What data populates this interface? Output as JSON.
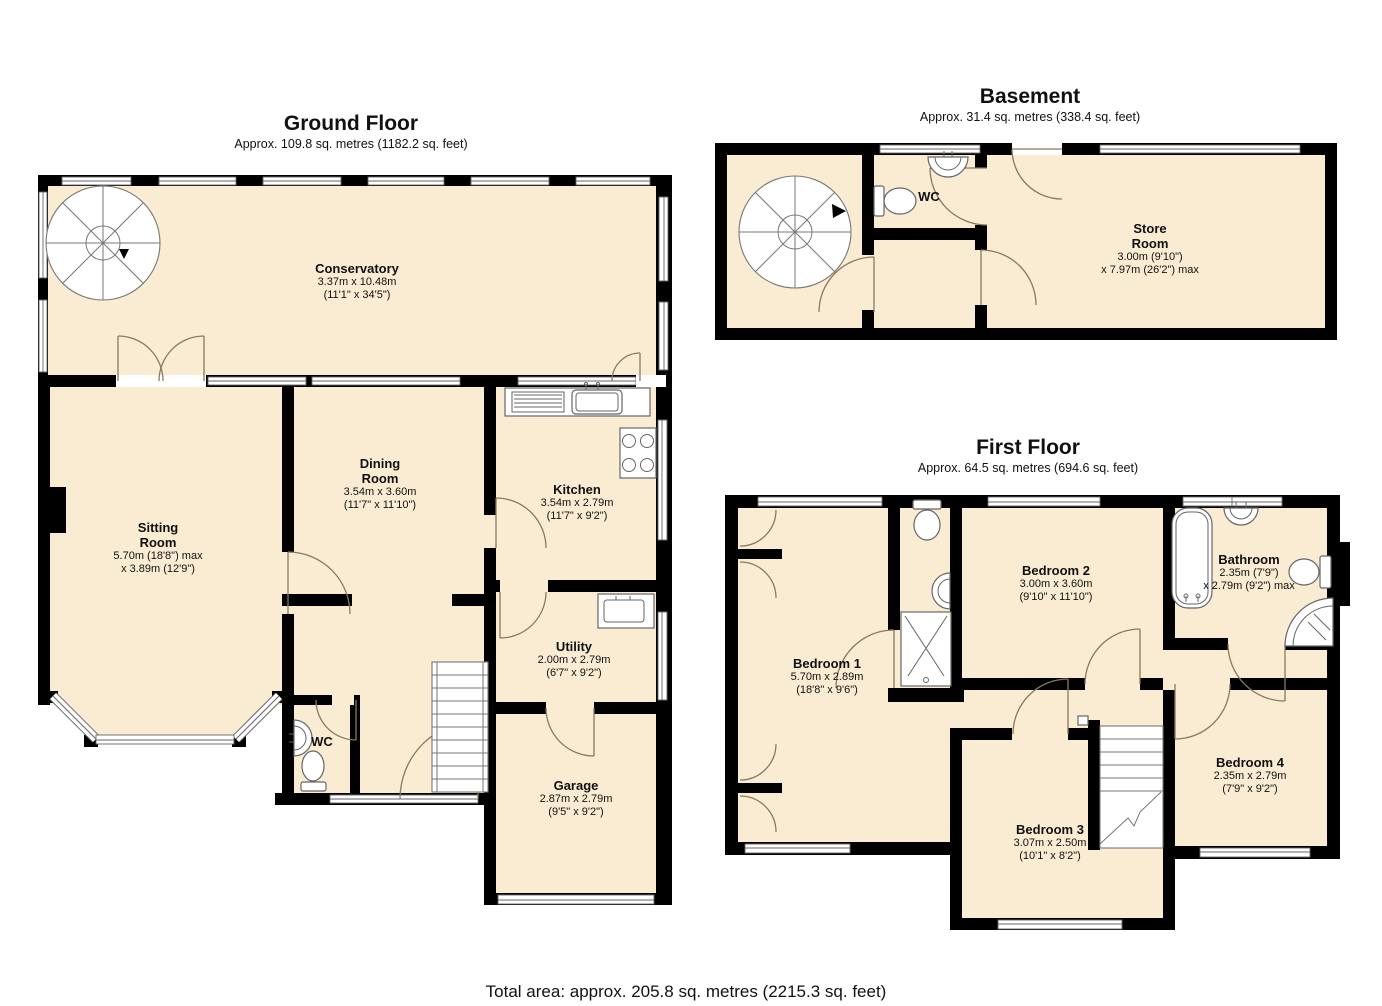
{
  "page": {
    "total_area": "Total area: approx. 205.8 sq. metres (2215.3 sq. feet)"
  },
  "colors": {
    "room_fill": "#FAECD2",
    "wall": "#000000",
    "door_arc": "#8A795D",
    "fixture_stroke": "#666666"
  },
  "fixtures": {
    "ground": [
      "spiral-staircase",
      "staircase",
      "kitchen-sink",
      "hob",
      "utility-sink",
      "wc-sink",
      "wc-toilet",
      "bay-window",
      "garage-door",
      "front-door"
    ],
    "basement": [
      "spiral-staircase",
      "wc-sink",
      "wc-toilet"
    ],
    "first": [
      "staircase",
      "ensuite-toilet",
      "ensuite-sink",
      "shower-tray",
      "bath",
      "bathroom-sink",
      "bathroom-toilet",
      "corner-shower",
      "wardrobe-doors"
    ]
  },
  "floors": {
    "ground": {
      "title": "Ground Floor",
      "subtitle": "Approx. 109.8 sq. metres (1182.2 sq. feet)",
      "rooms": {
        "conservatory": {
          "name": "Conservatory",
          "dims1": "3.37m x 10.48m",
          "dims2": "(11'1\" x 34'5\")"
        },
        "sitting_room": {
          "name": "Sitting\nRoom",
          "dims1": "5.70m (18'8\") max",
          "dims2": "x 3.89m (12'9\")"
        },
        "dining_room": {
          "name": "Dining\nRoom",
          "dims1": "3.54m x 3.60m",
          "dims2": "(11'7\" x 11'10\")"
        },
        "kitchen": {
          "name": "Kitchen",
          "dims1": "3.54m x 2.79m",
          "dims2": "(11'7\" x 9'2\")"
        },
        "utility": {
          "name": "Utility",
          "dims1": "2.00m x 2.79m",
          "dims2": "(6'7\" x 9'2\")"
        },
        "wc": {
          "name": "WC"
        },
        "garage": {
          "name": "Garage",
          "dims1": "2.87m x 2.79m",
          "dims2": "(9'5\" x 9'2\")"
        }
      }
    },
    "basement": {
      "title": "Basement",
      "subtitle": "Approx. 31.4 sq. metres (338.4 sq. feet)",
      "rooms": {
        "wc": {
          "name": "WC"
        },
        "store_room": {
          "name": "Store\nRoom",
          "dims1": "3.00m (9'10\")",
          "dims2": "x 7.97m (26'2\") max"
        }
      }
    },
    "first": {
      "title": "First Floor",
      "subtitle": "Approx. 64.5 sq. metres (694.6 sq. feet)",
      "rooms": {
        "bedroom1": {
          "name": "Bedroom 1",
          "dims1": "5.70m x 2.89m",
          "dims2": "(18'8\" x 9'6\")"
        },
        "bedroom2": {
          "name": "Bedroom 2",
          "dims1": "3.00m x 3.60m",
          "dims2": "(9'10\" x 11'10\")"
        },
        "bathroom": {
          "name": "Bathroom",
          "dims1": "2.35m (7'9\")",
          "dims2": "x 2.79m (9'2\") max"
        },
        "bedroom3": {
          "name": "Bedroom 3",
          "dims1": "3.07m x 2.50m",
          "dims2": "(10'1\" x 8'2\")"
        },
        "bedroom4": {
          "name": "Bedroom 4",
          "dims1": "2.35m x 2.79m",
          "dims2": "(7'9\" x 9'2\")"
        }
      }
    }
  }
}
